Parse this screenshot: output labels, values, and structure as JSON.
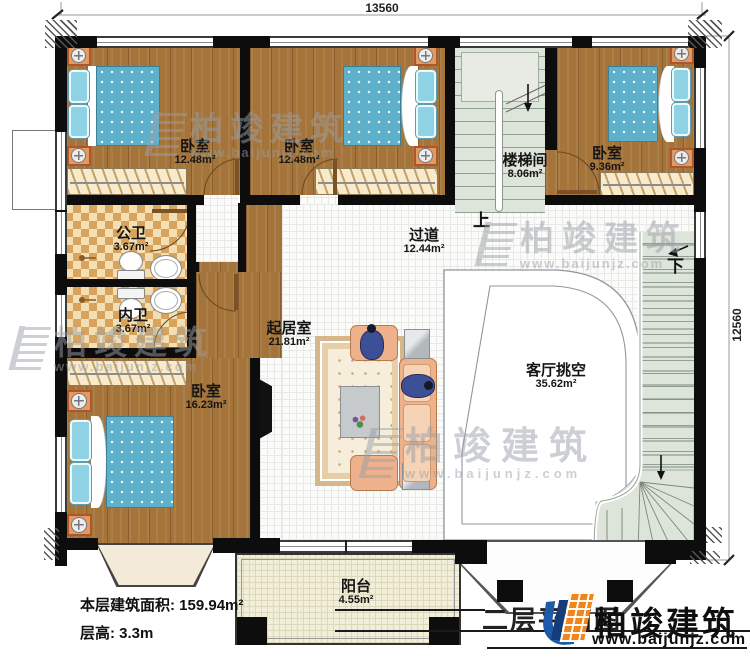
{
  "dimensions": {
    "top": "13560",
    "right": "12560"
  },
  "rooms": {
    "bedroom1": {
      "name": "卧室",
      "area": "12.48m²"
    },
    "bedroom2": {
      "name": "卧室",
      "area": "12.48m²"
    },
    "stairwell": {
      "name": "楼梯间",
      "area": "8.06m²"
    },
    "bedroom3": {
      "name": "卧室",
      "area": "9.36m²"
    },
    "public_bath": {
      "name": "公卫",
      "area": "3.67m²"
    },
    "private_bath": {
      "name": "内卫",
      "area": "3.67m²"
    },
    "bedroom4": {
      "name": "卧室",
      "area": "16.23m²"
    },
    "corridor": {
      "name": "过道",
      "area": "12.44m²"
    },
    "living": {
      "name": "起居室",
      "area": "21.81m²"
    },
    "void": {
      "name": "客厅挑空",
      "area": "35.62m²"
    },
    "balcony": {
      "name": "阳台",
      "area": "4.55m²"
    }
  },
  "stairs": {
    "up": "上",
    "down": "下"
  },
  "footer": {
    "floor_area": "本层建筑面积: 159.94m²",
    "floor_height": "层高: 3.3m"
  },
  "title_block": {
    "plan_title": "二层平面图",
    "brand_name": "柏竣建筑",
    "brand_url": "www.baijunjz.com"
  },
  "watermark": {
    "brand": "柏竣建筑",
    "url": "www.baijunjz.com"
  },
  "colors": {
    "brand_orange": "#f08519",
    "brand_blue": "#1e5aa8"
  }
}
